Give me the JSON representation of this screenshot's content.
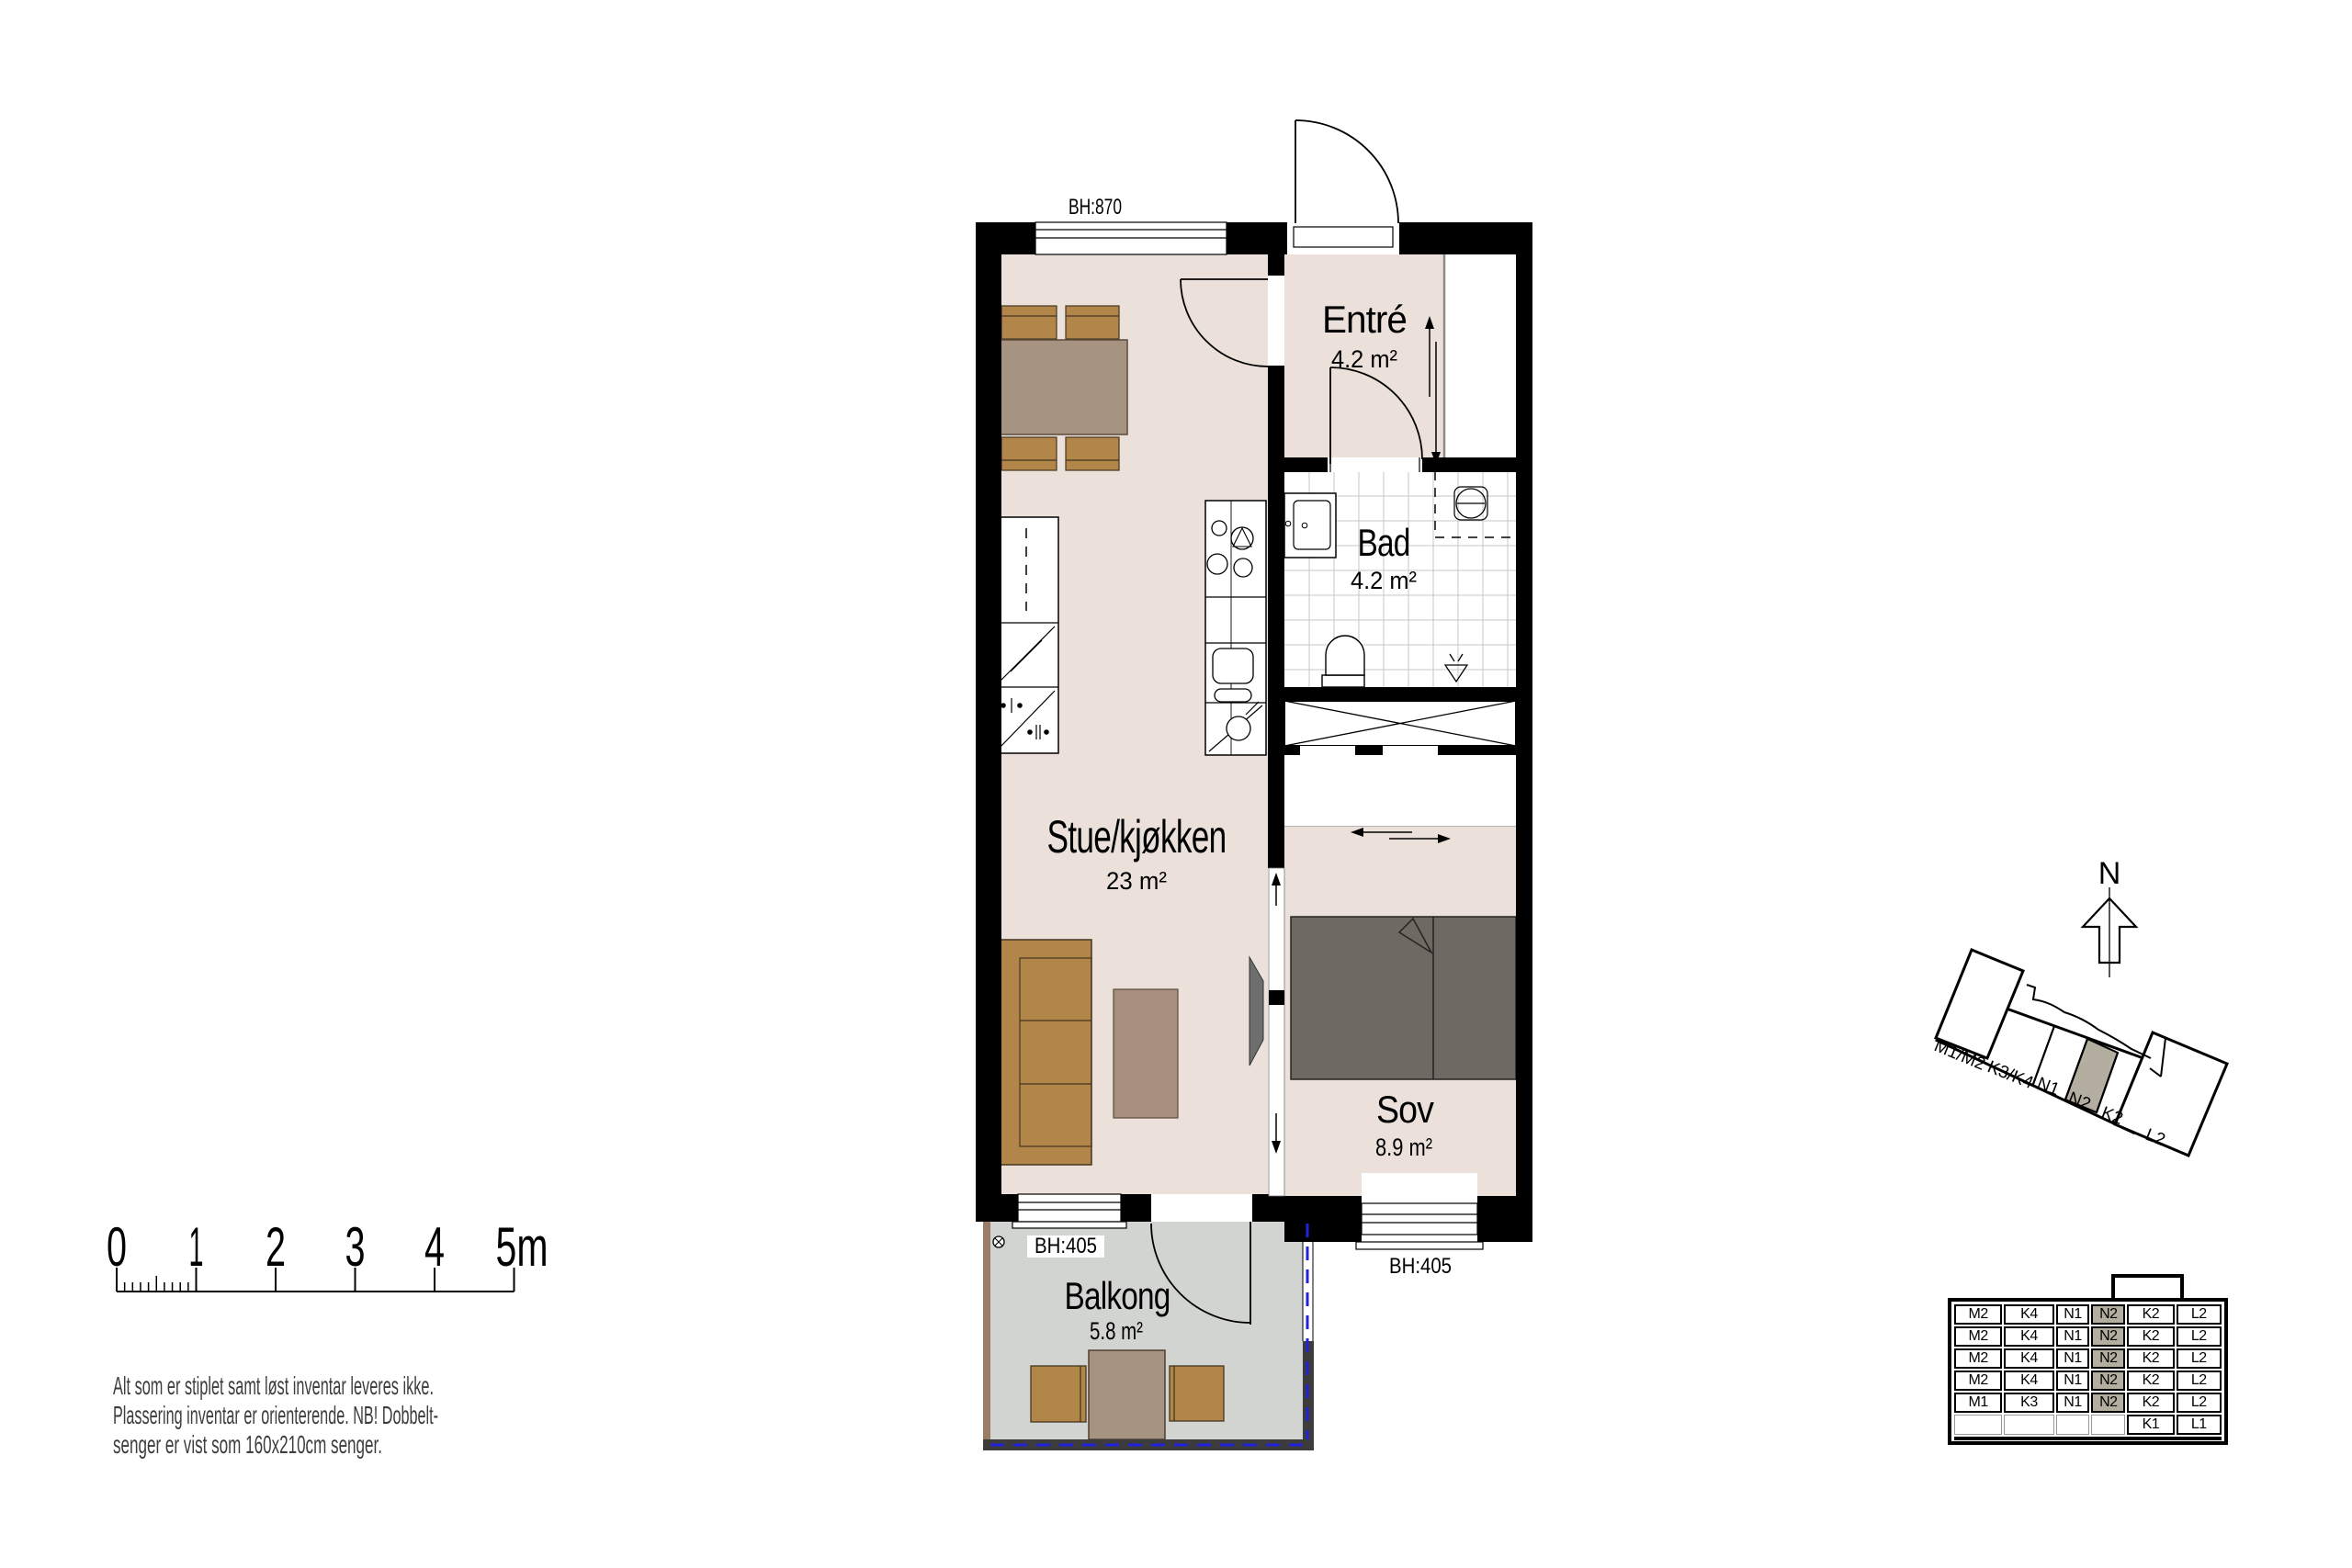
{
  "plan": {
    "bh_top": "BH:870",
    "bh_balcony": "BH:405",
    "bh_sov": "BH:405",
    "rooms": {
      "entre": {
        "name": "Entré",
        "area": "4.2 m²"
      },
      "bad": {
        "name": "Bad",
        "area": "4.2 m²"
      },
      "stue": {
        "name": "Stue/kjøkken",
        "area": "23 m²"
      },
      "sov": {
        "name": "Sov",
        "area": "8.9 m²"
      },
      "balkong": {
        "name": "Balkong",
        "area": "5.8 m²"
      }
    }
  },
  "scalebar": {
    "labels": [
      "0",
      "1",
      "2",
      "3",
      "4",
      "5m"
    ]
  },
  "disclaimer": {
    "line1": "Alt som er stiplet samt løst inventar leveres ikke.",
    "line2": "Plassering inventar er orienterende. NB! Dobbelt-",
    "line3": "senger er vist som 160x210cm senger."
  },
  "compass": {
    "label": "N"
  },
  "site": {
    "labels": [
      "M1/M2",
      "K3/K4",
      "N1",
      "N2",
      "K2",
      "L2"
    ],
    "highlight": "N2"
  },
  "schedule": {
    "rows": [
      [
        "M2",
        "K4",
        "N1",
        "N2",
        "K2",
        "L2"
      ],
      [
        "M2",
        "K4",
        "N1",
        "N2",
        "K2",
        "L2"
      ],
      [
        "M2",
        "K4",
        "N1",
        "N2",
        "K2",
        "L2"
      ],
      [
        "M2",
        "K4",
        "N1",
        "N2",
        "K2",
        "L2"
      ],
      [
        "M1",
        "K3",
        "N1",
        "N2",
        "K2",
        "L2"
      ],
      [
        "",
        "",
        "",
        "",
        "K1",
        "L1"
      ]
    ]
  },
  "colors": {
    "floor": "#ece1da",
    "balcony_floor": "#d2d4d1",
    "bed": "#6e6a63",
    "wood": "#b28549",
    "table_wood": "#a79382",
    "highlight": "#b3ae9f",
    "rail_blue": "#2222dd"
  }
}
